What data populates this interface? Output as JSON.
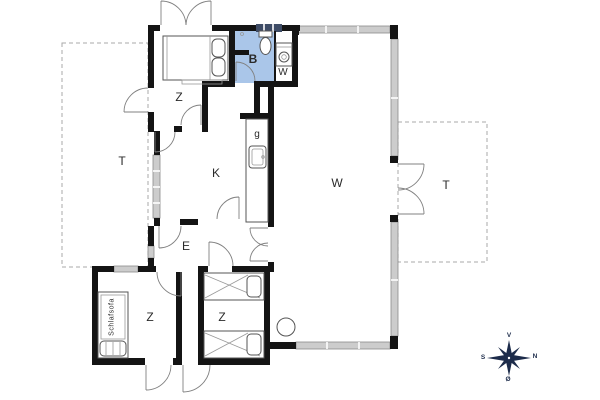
{
  "plan": {
    "title": "holiday-house-floor-plan",
    "labels": {
      "bedroom1": "Z",
      "terrace_left": "T",
      "kitchen": "K",
      "bathroom": "B",
      "utility": "W",
      "hob": "g",
      "living": "W",
      "hall": "E",
      "bedroom2": "Z",
      "bedroom3": "Z",
      "sleeper_sofa": "Schlafsofa",
      "terrace_right": "T"
    },
    "compass": {
      "up": "V",
      "right": "N",
      "left": "S",
      "down": "Ø"
    },
    "colors": {
      "wall": "#141414",
      "bathroom": "#aac6e9",
      "glazing": "#cccccc",
      "glazing_border": "#8a8a8a",
      "dash": "#aaaaaa",
      "compass": "#1c2b4a",
      "label": "#2a2a2a"
    }
  }
}
